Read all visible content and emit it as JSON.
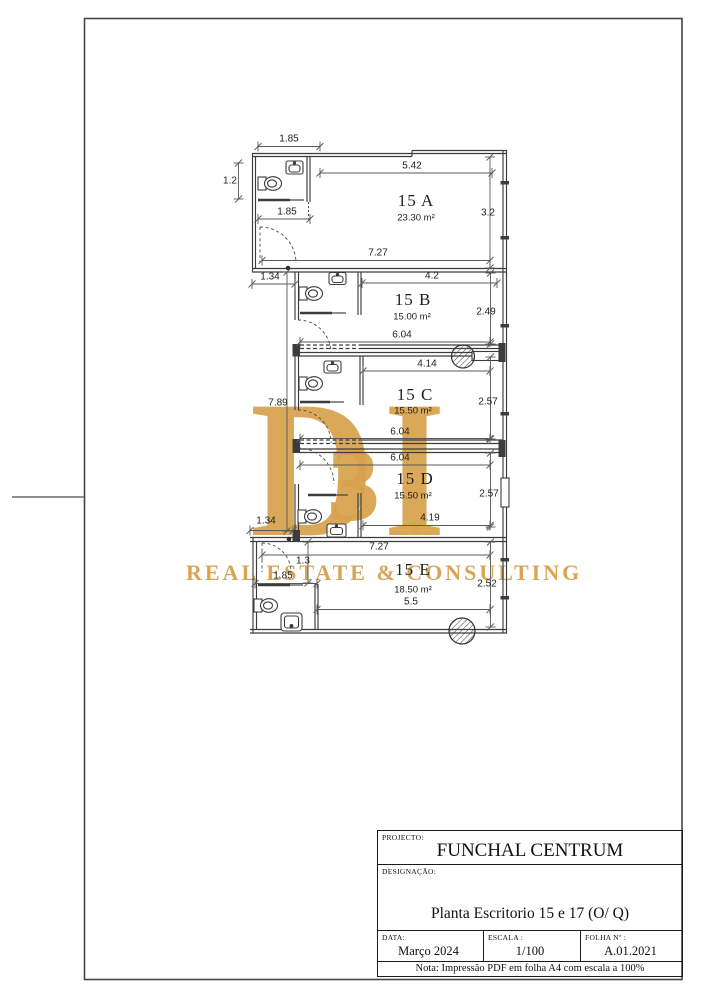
{
  "watermark": {
    "letter_d": "D",
    "letter_3": "3",
    "letter_i": "I",
    "registered": "®",
    "tagline": "REAL ESTATE & CONSULTING",
    "gold_color": "#D7A14C"
  },
  "title_block": {
    "projecto_label": "PROJECTO:",
    "projecto": "FUNCHAL CENTRUM",
    "designacao_label": "DESIGNAÇÃO:",
    "designacao": "Planta Escritorio  15 e 17 (O/ Q)",
    "data_label": "DATA:",
    "data": "Março 2024",
    "escala_label": "ESCALA :",
    "escala": "1/100",
    "folha_label": "FOLHA Nº :",
    "folha": "A.01.2021",
    "nota": "Nota: Impressão PDF em folha A4 com escala a 100%"
  },
  "plan": {
    "line_color": "#3c3c3c",
    "rooms": [
      {
        "name": "15 A",
        "area": "23.30 m²",
        "nx": 416,
        "ny": 201,
        "ax": 416,
        "ay": 218
      },
      {
        "name": "15 B",
        "area": "15.00 m²",
        "nx": 413,
        "ny": 300,
        "ax": 412,
        "ay": 317
      },
      {
        "name": "15 C",
        "area": "15.50 m²",
        "nx": 415,
        "ny": 395,
        "ax": 413,
        "ay": 411
      },
      {
        "name": "15 D",
        "area": "15.50 m²",
        "nx": 415,
        "ny": 479,
        "ax": 413,
        "ay": 496
      },
      {
        "name": "15 E",
        "area": "18.50 m²",
        "nx": 413,
        "ny": 570,
        "ax": 413,
        "ay": 590
      }
    ],
    "dimensions": [
      {
        "t": "1.85",
        "x": 289,
        "y": 139,
        "l": [
          258,
          146.5,
          320,
          146.5
        ]
      },
      {
        "t": "1.2",
        "x": 230,
        "y": 181,
        "l": [
          238.5,
          163,
          238.5,
          199
        ]
      },
      {
        "t": "5.42",
        "x": 412,
        "y": 166,
        "l": [
          320,
          173,
          492,
          173
        ]
      },
      {
        "t": "1.85",
        "x": 287,
        "y": 212,
        "l": [
          258,
          219,
          310,
          219
        ]
      },
      {
        "t": "3.2",
        "x": 488,
        "y": 213,
        "l": [
          490,
          157,
          490,
          268
        ]
      },
      {
        "t": "7.27",
        "x": 378,
        "y": 253,
        "l": [
          262,
          260.5,
          490,
          260.5
        ]
      },
      {
        "t": "1.34",
        "x": 270,
        "y": 277,
        "l": [
          252,
          284,
          295,
          284
        ]
      },
      {
        "t": "4.2",
        "x": 432,
        "y": 276,
        "l": [
          362,
          283,
          497,
          283
        ]
      },
      {
        "t": "2.49",
        "x": 486,
        "y": 312,
        "l": [
          490.5,
          273,
          490.5,
          344
        ]
      },
      {
        "t": "6.04",
        "x": 402,
        "y": 335,
        "l": [
          300,
          342,
          490,
          342
        ]
      },
      {
        "t": "4.14",
        "x": 427,
        "y": 364,
        "l": [
          363,
          371,
          490,
          371
        ]
      },
      {
        "t": "2.57",
        "x": 488,
        "y": 402,
        "l": [
          490.5,
          357,
          490.5,
          439
        ]
      },
      {
        "t": "7.89",
        "x": 278,
        "y": 403,
        "l": [
          287,
          272,
          287,
          531
        ]
      },
      {
        "t": "6.04",
        "x": 400,
        "y": 432,
        "l": [
          300,
          438.5,
          490,
          438.5
        ]
      },
      {
        "t": "6.04",
        "x": 400,
        "y": 458,
        "l": [
          300,
          465,
          490,
          465
        ]
      },
      {
        "t": "2.57",
        "x": 489,
        "y": 494,
        "l": [
          490.5,
          453,
          490.5,
          527
        ]
      },
      {
        "t": "4.19",
        "x": 430,
        "y": 518,
        "l": [
          363,
          525.5,
          490,
          525.5
        ]
      },
      {
        "t": "1.34",
        "x": 266,
        "y": 521,
        "l": [
          250,
          530.5,
          293,
          530.5
        ]
      },
      {
        "t": "7.27",
        "x": 379,
        "y": 547,
        "l": [
          262,
          555,
          490,
          555
        ]
      },
      {
        "t": "1.3",
        "x": 303,
        "y": 561,
        "l": [
          308,
          542,
          308,
          583
        ]
      },
      {
        "t": "1.85",
        "x": 283,
        "y": 576,
        "l": [
          255,
          583.5,
          317,
          583.5
        ]
      },
      {
        "t": "2.52",
        "x": 487,
        "y": 584,
        "l": [
          490.5,
          542,
          490.5,
          627
        ]
      },
      {
        "t": "5.5",
        "x": 411,
        "y": 602,
        "l": [
          317,
          609.5,
          490,
          609.5
        ]
      }
    ]
  }
}
